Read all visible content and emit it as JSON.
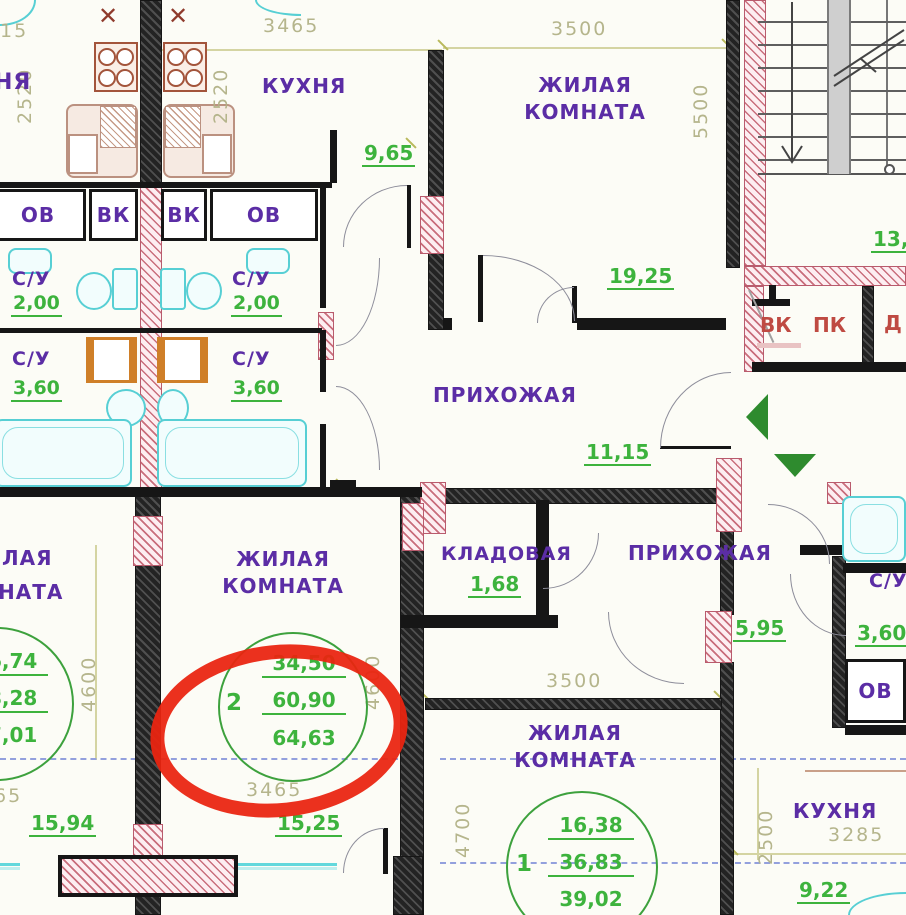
{
  "colors": {
    "room_label": "#5b2da5",
    "area_value": "#3db33d",
    "dimension": "#b2b287",
    "shaft_red": "#bf4a42",
    "plumbing_cyan": "#57cfd4",
    "washer_orange": "#cf7f28",
    "wall_hatch_pink": "#c96e7c",
    "highlight_red": "#ea2410",
    "section_line_blue": "#93a0dd"
  },
  "labels": {
    "kitchen": "КУХНЯ",
    "kitchen_partial": "НЯ",
    "living1": "ЖИЛАЯ",
    "living2": "КОМНАТА",
    "living_partial1": "ЛАЯ",
    "living_partial2": "НАТА",
    "hall": "ПРИХОЖАЯ",
    "pantry": "КЛАДОВАЯ",
    "su": "С/У",
    "ov": "ОВ",
    "vk": "ВК",
    "pk": "ПК",
    "d": "Д",
    "vent_mark": "✕"
  },
  "areas": {
    "kitchen_top": "9,65",
    "living_top": "19,25",
    "hall_top": "11,15",
    "su_small": "2,00",
    "su_big": "3,60",
    "pantry": "1,68",
    "hall_bottom": "5,95",
    "su_right": "3,60",
    "stairs": "13,5",
    "room_left": "15,94",
    "room_center": "15,25",
    "kitchen_br": "9,22"
  },
  "dims": {
    "w3465": "3465",
    "w3500": "3500",
    "h2520": "2520",
    "h5500": "5500",
    "h4600": "4600",
    "w3465b": "3465",
    "w3500b": "3500",
    "h4700": "4700",
    "h2500": "2500",
    "w3285": "3285",
    "partial15": "15",
    "partial65": "65"
  },
  "stamps": {
    "left": {
      "number": "",
      "values": [
        "6,74",
        "8,28",
        "7,01"
      ]
    },
    "center": {
      "number": "2",
      "values": [
        "34,50",
        "60,90",
        "64,63"
      ]
    },
    "bottom": {
      "number": "1",
      "values": [
        "16,38",
        "36,83",
        "39,02"
      ]
    }
  }
}
